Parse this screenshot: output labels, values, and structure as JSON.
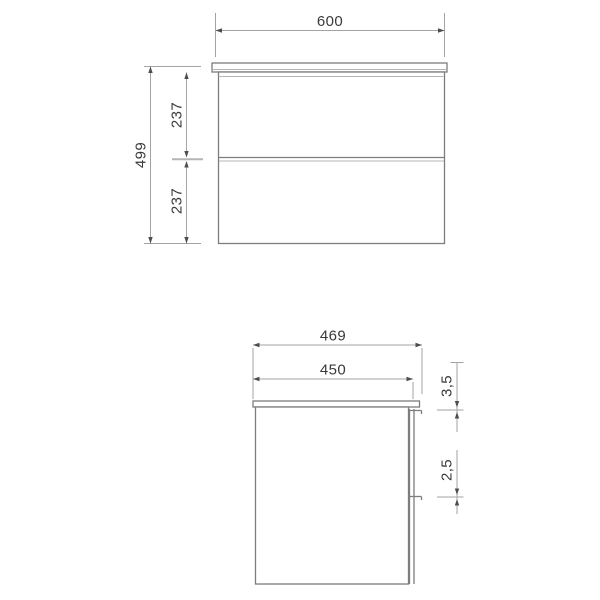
{
  "colors": {
    "background": "#ffffff",
    "outline": "#7d7d7d",
    "light_line": "#b5b5b5",
    "dimension_line": "#a3a3a3",
    "arrow": "#4d4d4d",
    "text": "#3a3a3a"
  },
  "front_view": {
    "width": "600",
    "height": "499",
    "drawer_top_height": "237",
    "drawer_bottom_height": "237"
  },
  "side_view": {
    "depth_total": "469",
    "depth_body": "450",
    "gap_top": "3,5",
    "gap_between_drawers": "2,5"
  }
}
